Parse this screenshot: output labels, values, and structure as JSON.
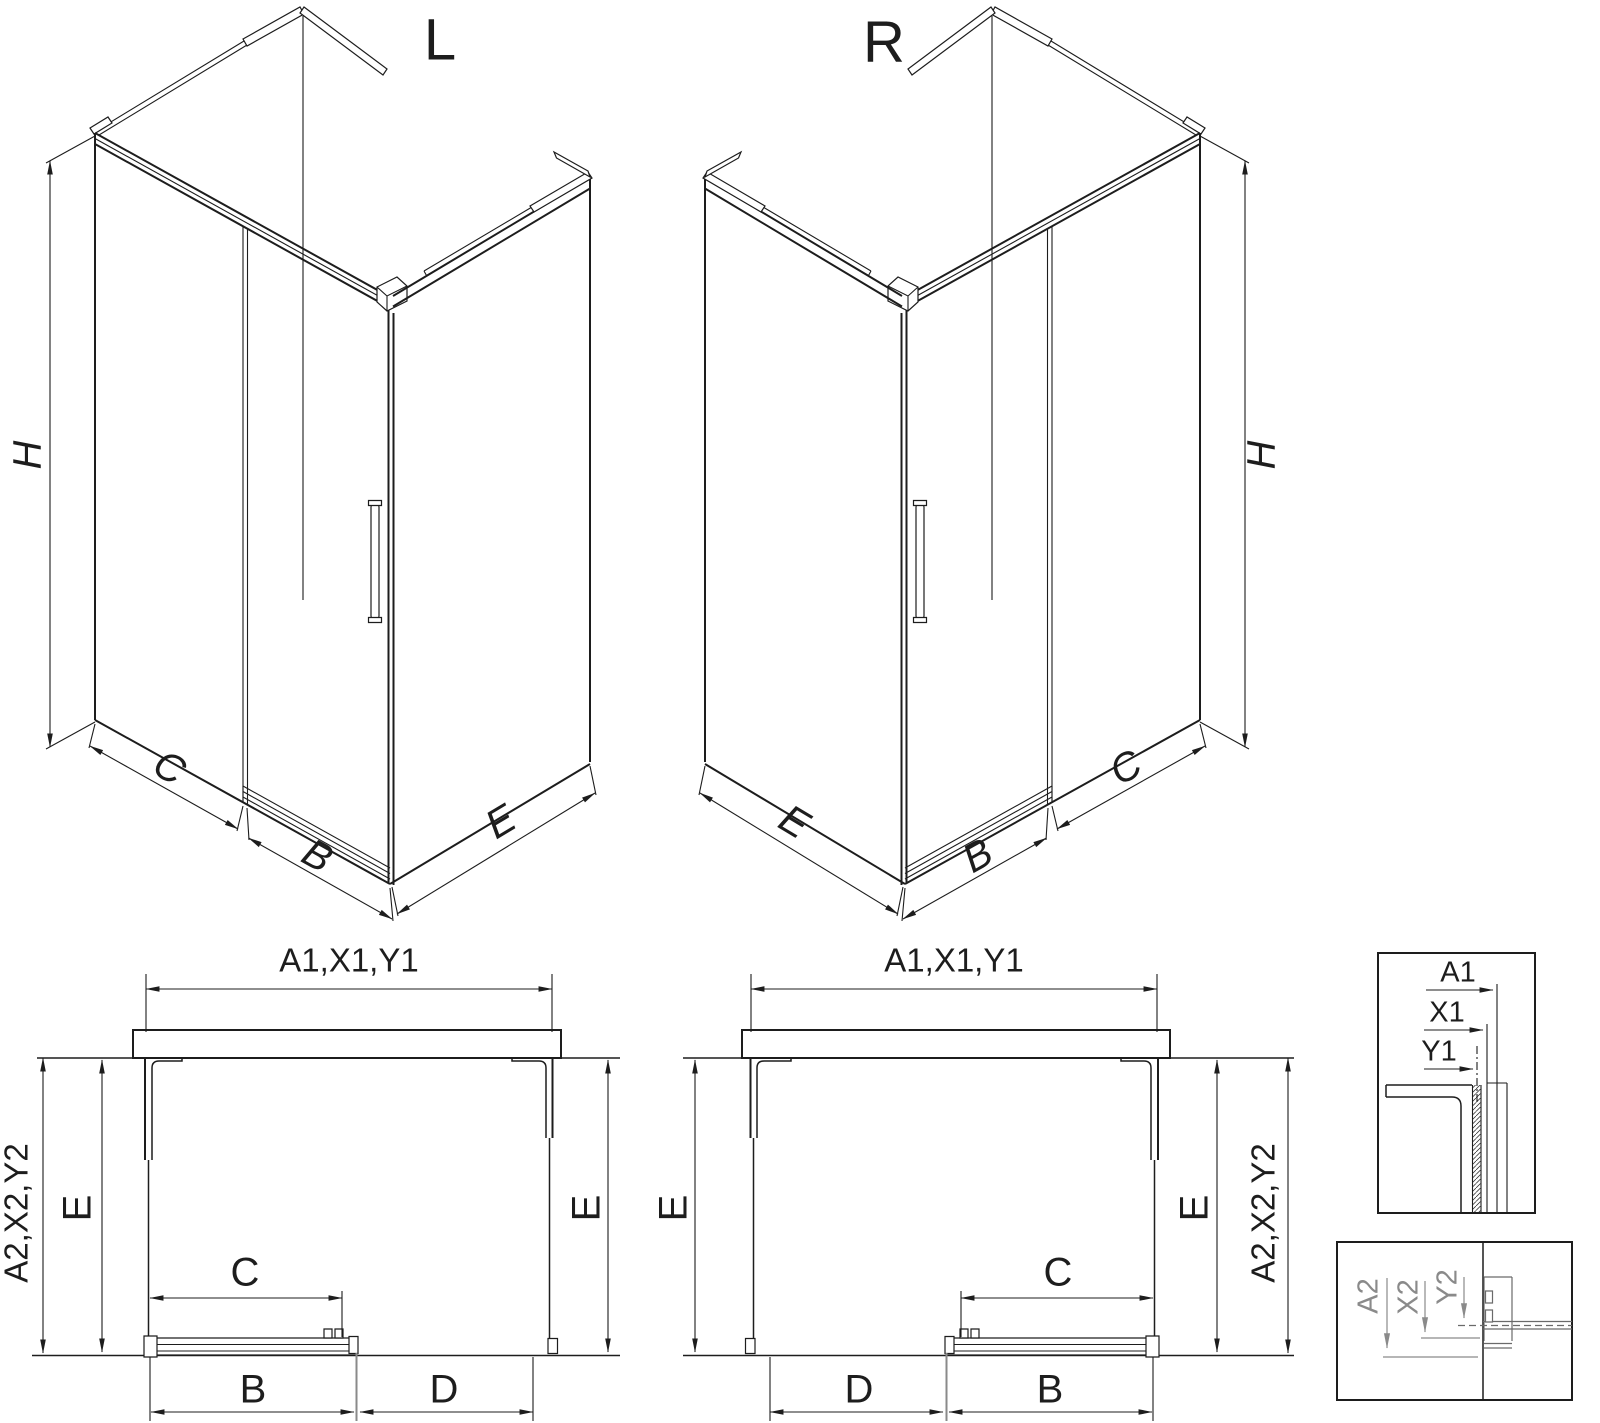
{
  "colors": {
    "background": "#ffffff",
    "line": "#1d1d1d",
    "muted": "#8a8a8a"
  },
  "views": {
    "iso_left": {
      "label": "L",
      "height": "H",
      "fixed_panel": "C",
      "door": "B",
      "side_panel": "E"
    },
    "iso_right": {
      "label": "R",
      "height": "H",
      "fixed_panel": "C",
      "door": "B",
      "side_panel": "E"
    },
    "plan_left": {
      "width_top": "A1,X1,Y1",
      "depth_outer": "A2,X2,Y2",
      "depth_left": "E",
      "depth_right": "E",
      "fixed_panel": "C",
      "door": "B",
      "opening": "D"
    },
    "plan_right": {
      "width_top": "A1,X1,Y1",
      "depth_outer": "A2,X2,Y2",
      "depth_left": "E",
      "depth_right": "E",
      "fixed_panel": "C",
      "door": "B",
      "opening": "D"
    },
    "detail_top": {
      "a": "A1",
      "x": "X1",
      "y": "Y1"
    },
    "detail_bottom": {
      "a": "A2",
      "x": "X2",
      "y": "Y2"
    }
  }
}
